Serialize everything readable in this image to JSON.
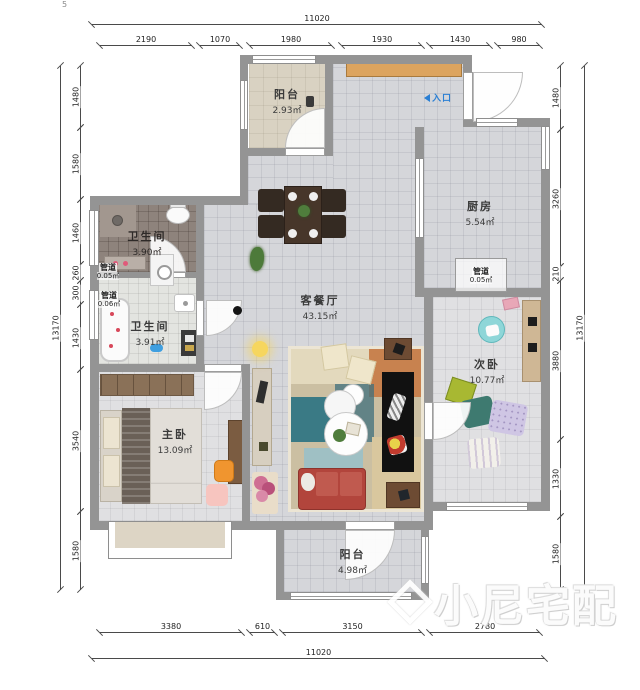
{
  "artifact": "5",
  "watermark": {
    "text": "小尼宅配"
  },
  "entrance": {
    "label": "入口"
  },
  "rooms": {
    "balcony_top": {
      "name": "阳台",
      "area": "2.93㎡"
    },
    "kitchen": {
      "name": "厨房",
      "area": "5.54㎡"
    },
    "duct_kitchen": {
      "name": "管道",
      "area": "0.05㎡"
    },
    "bath_upper": {
      "name": "卫生间",
      "area": "3.90㎡"
    },
    "duct_left_upper": {
      "name": "管道",
      "area": "0.05㎡"
    },
    "duct_left_lower": {
      "name": "管道",
      "area": "0.06㎡"
    },
    "bath_lower": {
      "name": "卫生间",
      "area": "3.91㎡"
    },
    "living": {
      "name": "客餐厅",
      "area": "43.15㎡"
    },
    "bedroom_second": {
      "name": "次卧",
      "area": "10.77㎡"
    },
    "bedroom_master": {
      "name": "主卧",
      "area": "13.09㎡"
    },
    "balcony_bottom": {
      "name": "阳台",
      "area": "4.98㎡"
    }
  },
  "dimensions": {
    "top": {
      "total": "11020",
      "segments": [
        "2190",
        "1070",
        "1980",
        "1930",
        "1430",
        "980"
      ]
    },
    "bottom": {
      "total": "11020",
      "segments": [
        "3380",
        "610",
        "3150",
        "2780"
      ]
    },
    "left": {
      "total": "13170",
      "segments": [
        "1480",
        "1580",
        "1460",
        "260",
        "300",
        "1430",
        "3540",
        "1580"
      ]
    },
    "right": {
      "total": "13170",
      "segments": [
        "1480",
        "3260",
        "210",
        "3880",
        "1330",
        "1580"
      ]
    }
  },
  "colors": {
    "wall": "#949494",
    "entrance_blue": "#2a7fd4",
    "sofa_red": "#b2453c",
    "balcony_floor": "#d9d2c2",
    "watermark": "#ffffff"
  }
}
